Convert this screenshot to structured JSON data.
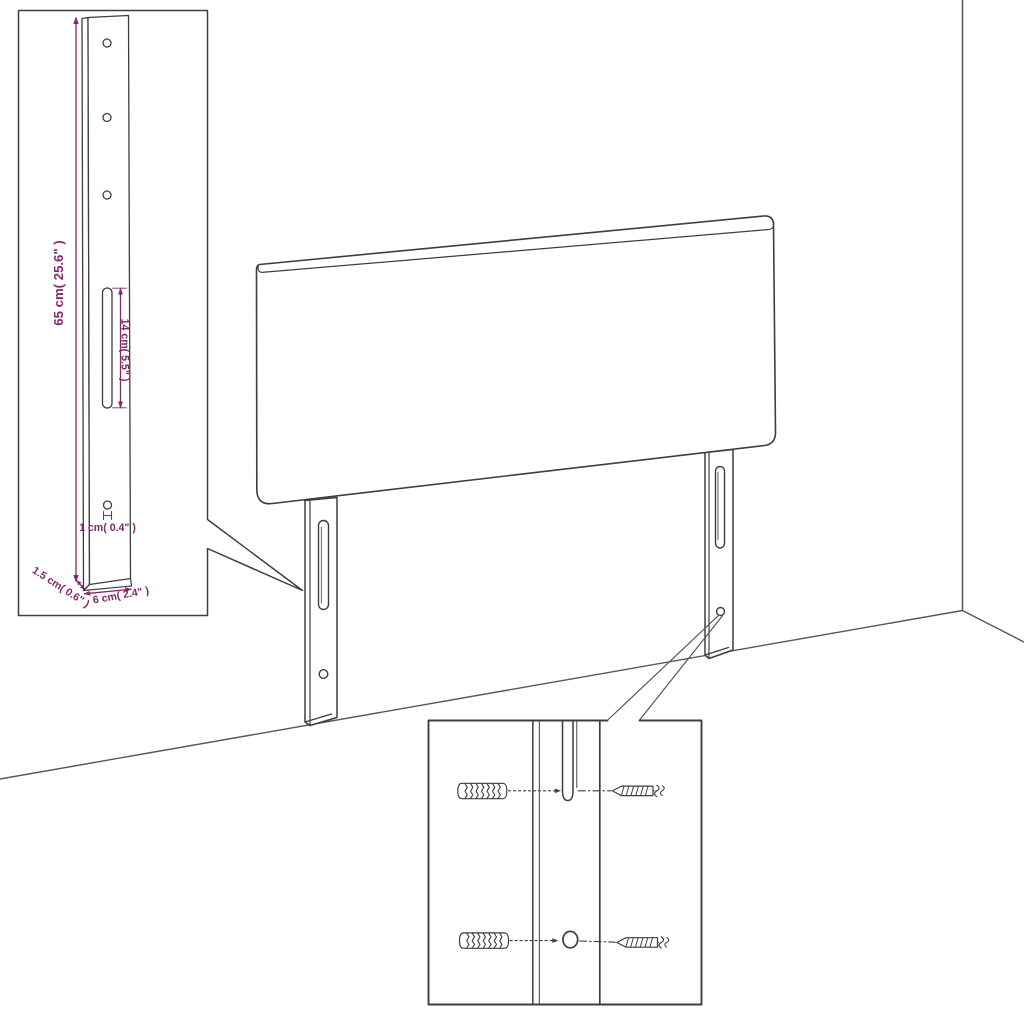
{
  "illustration": {
    "description": "Headboard wall-mounting assembly diagram with dimension inset and screw detail inset",
    "background": "#ffffff",
    "line_color": "#3d3e42",
    "room_line_color": "#56575c",
    "dimension_color": "#802a68",
    "dimensions": {
      "leg_height": "65 cm( 25.6\" )",
      "slot_length": "14 cm( 5.5\" )",
      "hole_diameter": "1 cm( 0.4\" )",
      "leg_thickness": "1.5 cm( 0.6\" )",
      "leg_width": "6 cm( 2.4\" )"
    }
  }
}
